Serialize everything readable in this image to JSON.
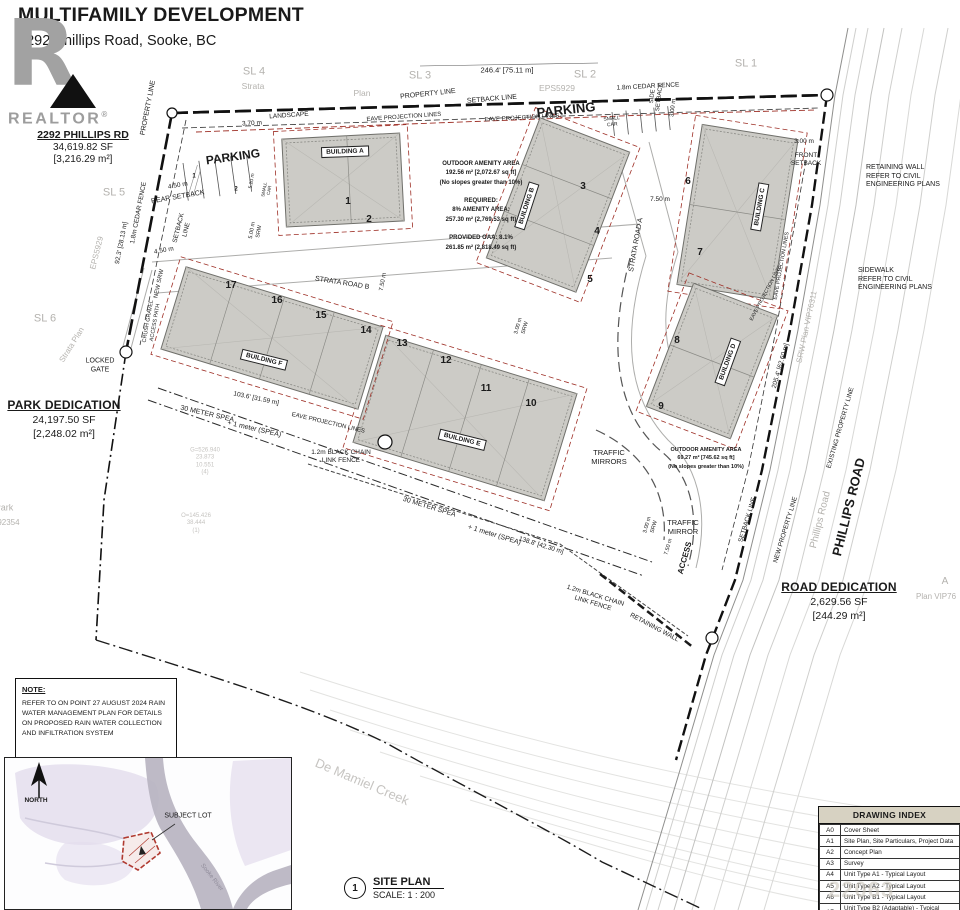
{
  "header": {
    "title": "MULTIFAMILY DEVELOPMENT",
    "subtitle": "2292 Phillips Road, Sooke, BC"
  },
  "logo": {
    "letter": "R",
    "name": "REALTOR",
    "reg": "®"
  },
  "parcel": {
    "name": "2292 PHILLIPS RD",
    "area_sf": "34,619.82 SF",
    "area_m2": "[3,216.29 m²]"
  },
  "park_dedication": {
    "title": "PARK DEDICATION",
    "area_sf": "24,197.50 SF",
    "area_m2": "[2,248.02 m²]"
  },
  "road_dedication": {
    "title": "ROAD DEDICATION",
    "area_sf": "2,629.56 SF",
    "area_m2": "[244.29 m²]"
  },
  "amenity_main": {
    "text": "OUTDOOR AMENITY AREA\n192.56 m² [2,072.67 sq ft]\n(No slopes greater than 10%)\n\nREQUIRED:\n8% AMENITY AREA:\n257.30 m² (2,769.53 sq ft)\n\nPROVIDED OAA: 8.1%\n261.85 m² (2,818.49 sq ft)"
  },
  "amenity_secondary": {
    "text": "OUTDOOR AMENITY AREA\n69.27 m² [745.62 sq ft]\n(No slopes greater than 10%)"
  },
  "note": {
    "heading": "NOTE:",
    "body": "REFER TO ON POINT 27 AUGUST 2024 RAIN\nWATER MANAGEMENT PLAN FOR DETAILS\nON PROPOSED RAIN WATER COLLECTION\nAND INFILTRATION SYSTEM"
  },
  "site_plan_title": {
    "number": "1",
    "label": "SITE PLAN",
    "scale": "SCALE: 1 : 200"
  },
  "drawing_index": {
    "title": "DRAWING INDEX",
    "rows": [
      [
        "A0",
        "Cover Sheet"
      ],
      [
        "A1",
        "Site Plan, Site Particulars, Project Data"
      ],
      [
        "A2",
        "Concept Plan"
      ],
      [
        "A3",
        "Survey"
      ],
      [
        "A4",
        "Unit Type A1 - Typical Layout"
      ],
      [
        "A5",
        "Unit Type A2 - Typical Layout"
      ],
      [
        "A6",
        "Unit Type B1 - Typical Layout"
      ],
      [
        "A7",
        "Unit Type B2 (Adaptable) - Typical Layout"
      ]
    ]
  },
  "watermark": "22063",
  "colors": {
    "grey_label": "#b4b2ae",
    "faint_label": "#c6c4c1",
    "red_dash": "#9e2f26",
    "building_fill": "#cccbc6",
    "index_header_bg": "#d7d2c2",
    "inset_lavender": "#ded8e8",
    "inset_river": "#b7b2c0",
    "subject_lot_red": "#b03a30"
  },
  "annotations": [
    {
      "t": "SL 4",
      "x": 254,
      "y": 72,
      "s": 11,
      "c": "#b4b2ae",
      "n": "sl4-label"
    },
    {
      "t": "Strata",
      "x": 253,
      "y": 86,
      "s": 8.5,
      "c": "#b4b2ae"
    },
    {
      "t": "SL 3",
      "x": 420,
      "y": 76,
      "s": 11,
      "c": "#b4b2ae",
      "n": "sl3-label"
    },
    {
      "t": "Plan",
      "x": 362,
      "y": 93,
      "s": 8.5,
      "c": "#b4b2ae"
    },
    {
      "t": "246.4' [75.11 m]",
      "x": 507,
      "y": 70,
      "s": 7.5,
      "n": "top-dimension"
    },
    {
      "t": "SL 2",
      "x": 585,
      "y": 75,
      "s": 11,
      "c": "#b4b2ae",
      "n": "sl2-label"
    },
    {
      "t": "EPS5929",
      "x": 557,
      "y": 88,
      "s": 8.5,
      "c": "#b4b2ae"
    },
    {
      "t": "SL 1",
      "x": 746,
      "y": 64,
      "s": 11,
      "c": "#b4b2ae",
      "n": "sl1-label"
    },
    {
      "t": "1.8m CEDAR FENCE",
      "x": 648,
      "y": 87,
      "s": 6.5,
      "r": -3,
      "n": "cedar-fence-label"
    },
    {
      "t": "PROPERTY LINE",
      "x": 428,
      "y": 95,
      "s": 7,
      "r": -6
    },
    {
      "t": "SETBACK LINE",
      "x": 492,
      "y": 100,
      "s": 7,
      "r": -5
    },
    {
      "t": "PARKING",
      "x": 566,
      "y": 110,
      "s": 13,
      "b": 1,
      "r": -6,
      "n": "parking-label-east"
    },
    {
      "t": "EAVE PROJECTION LINES",
      "x": 404,
      "y": 118,
      "s": 6,
      "r": -4
    },
    {
      "t": "EAVE PROJECTION LINES",
      "x": 522,
      "y": 119,
      "s": 6,
      "r": -3
    },
    {
      "t": "SMALL\nCAR",
      "x": 612,
      "y": 122,
      "s": 5,
      "r": -6
    },
    {
      "t": "LANDSCAPE",
      "x": 289,
      "y": 116,
      "s": 6.5,
      "r": -4
    },
    {
      "t": "3.70 m",
      "x": 252,
      "y": 124,
      "s": 6.5,
      "r": -3
    },
    {
      "t": "SIDE\nSETBACK",
      "x": 657,
      "y": 97,
      "s": 6,
      "r": -83
    },
    {
      "t": "3.00 m",
      "x": 674,
      "y": 108,
      "s": 6,
      "r": -83
    },
    {
      "t": "3.00 m",
      "x": 804,
      "y": 142,
      "s": 6.5
    },
    {
      "t": "FRONT\nSETBACK",
      "x": 806,
      "y": 160,
      "s": 6.5
    },
    {
      "t": "RETAINING WALL\nREFER TO CIVIL\nENGINEERING PLANS",
      "x": 866,
      "y": 177,
      "s": 7,
      "a": "l",
      "n": "retaining-wall-note"
    },
    {
      "t": "SIDEWALK\nREFER TO CIVIL\nENGINEERING PLANS",
      "x": 858,
      "y": 280,
      "s": 7,
      "a": "l",
      "n": "sidewalk-note"
    },
    {
      "t": "SRW Plan VIP76311",
      "x": 807,
      "y": 327,
      "s": 8,
      "r": -78,
      "c": "#b4b2ae"
    },
    {
      "t": "205.4' [62.60 m]",
      "x": 781,
      "y": 366,
      "s": 6.5,
      "r": -74
    },
    {
      "t": "EXISTING PROPERTY LINE",
      "x": 841,
      "y": 428,
      "s": 6.5,
      "r": -74
    },
    {
      "t": "NEW PROPERTY LINE",
      "x": 786,
      "y": 530,
      "s": 6.5,
      "r": -73
    },
    {
      "t": "SETBACK LINE",
      "x": 748,
      "y": 520,
      "s": 6.5,
      "r": -73
    },
    {
      "t": "Phillips Road",
      "x": 821,
      "y": 520,
      "s": 10,
      "r": -76,
      "c": "#b4b2ae",
      "n": "phillips-road-grey-label"
    },
    {
      "t": "PHILLIPS ROAD",
      "x": 849,
      "y": 507,
      "s": 13,
      "r": -76,
      "b": 1,
      "n": "phillips-road-label"
    },
    {
      "t": "A",
      "x": 945,
      "y": 582,
      "s": 10,
      "c": "#b4b2ae"
    },
    {
      "t": "Plan VIP76",
      "x": 916,
      "y": 597,
      "s": 8,
      "c": "#b4b2ae",
      "a": "l"
    },
    {
      "t": "SL 5",
      "x": 114,
      "y": 193,
      "s": 11,
      "c": "#b4b2ae",
      "n": "sl5-label"
    },
    {
      "t": "EPS5929",
      "x": 97,
      "y": 253,
      "s": 8,
      "r": -76,
      "c": "#b4b2ae"
    },
    {
      "t": "SL 6",
      "x": 45,
      "y": 319,
      "s": 11,
      "c": "#b4b2ae",
      "n": "sl6-label"
    },
    {
      "t": "Strata  Plan",
      "x": 72,
      "y": 345,
      "s": 8,
      "r": -58,
      "c": "#b4b2ae"
    },
    {
      "t": "PROPERTY LINE",
      "x": 149,
      "y": 108,
      "s": 7,
      "r": -79
    },
    {
      "t": "92.3' [28.13 m]",
      "x": 122,
      "y": 243,
      "s": 6.5,
      "r": -79
    },
    {
      "t": "1.8m CEDAR FENCE",
      "x": 139,
      "y": 213,
      "s": 6.5,
      "r": -79
    },
    {
      "t": "REAR SETBACK",
      "x": 178,
      "y": 198,
      "s": 7,
      "r": -10
    },
    {
      "t": "SETBACK\nLINE",
      "x": 183,
      "y": 229,
      "s": 6.5,
      "r": -76
    },
    {
      "t": "4.50 m",
      "x": 178,
      "y": 186,
      "s": 6.5,
      "r": -10
    },
    {
      "t": "4.50 m",
      "x": 164,
      "y": 251,
      "s": 6.5,
      "r": -10
    },
    {
      "t": "NEW SRW",
      "x": 160,
      "y": 284,
      "s": 6,
      "r": -78
    },
    {
      "t": "CRUSH GRAVEL\nACCESS PATH",
      "x": 152,
      "y": 322,
      "s": 5.5,
      "r": -80
    },
    {
      "t": "LOCKED\nGATE",
      "x": 100,
      "y": 366,
      "s": 7,
      "n": "locked-gate-label"
    },
    {
      "t": "30 METER SPEA",
      "x": 207,
      "y": 415,
      "s": 7,
      "r": 13
    },
    {
      "t": "+ 1 meter (SPEA)",
      "x": 254,
      "y": 430,
      "s": 7,
      "r": 13
    },
    {
      "t": "103.6' [31.59 m]",
      "x": 256,
      "y": 399,
      "s": 6.5,
      "r": 12
    },
    {
      "t": "EAVE PROJECTION LINES",
      "x": 328,
      "y": 424,
      "s": 6,
      "r": 13
    },
    {
      "t": "STRATA ROAD B",
      "x": 342,
      "y": 284,
      "s": 7,
      "r": 9,
      "n": "strata-road-b-label"
    },
    {
      "t": "7.50 m",
      "x": 384,
      "y": 282,
      "s": 6,
      "r": -80
    },
    {
      "t": "STRATA ROAD A",
      "x": 637,
      "y": 245,
      "s": 7,
      "r": -80,
      "n": "strata-road-a-label"
    },
    {
      "t": "7.50 m",
      "x": 660,
      "y": 200,
      "s": 6.5
    },
    {
      "t": "TRAFFIC\nMIRRORS",
      "x": 609,
      "y": 457,
      "s": 7.5,
      "n": "traffic-mirrors-label"
    },
    {
      "t": "TRAFFIC\nMIRROR",
      "x": 683,
      "y": 527,
      "s": 7.5
    },
    {
      "t": "ACCESS",
      "x": 685,
      "y": 558,
      "s": 8,
      "b": 1,
      "r": -74,
      "n": "access-label"
    },
    {
      "t": "3.00 m\nSRW",
      "x": 651,
      "y": 526,
      "s": 5.5,
      "r": -74
    },
    {
      "t": "7.50 m",
      "x": 669,
      "y": 547,
      "s": 5.5,
      "r": -74
    },
    {
      "t": "3.00 m\nSRW",
      "x": 522,
      "y": 327,
      "s": 5.5,
      "r": -74
    },
    {
      "t": "5.00 m\nSRW",
      "x": 256,
      "y": 231,
      "s": 5.5,
      "r": -80
    },
    {
      "t": "30 METER SPEA",
      "x": 429,
      "y": 508,
      "s": 7,
      "r": 17
    },
    {
      "t": "+ 1 meter (SPEA)",
      "x": 494,
      "y": 536,
      "s": 7,
      "r": 17
    },
    {
      "t": "138.8' [42.30 m]",
      "x": 541,
      "y": 546,
      "s": 6.5,
      "r": 17
    },
    {
      "t": "1.2m BLACK CHAIN\nLINK FENCE",
      "x": 341,
      "y": 457,
      "s": 6.5
    },
    {
      "t": "1.2m BLACK CHAIN\nLINK FENCE",
      "x": 594,
      "y": 600,
      "s": 6.5,
      "r": 17
    },
    {
      "t": "RETAINING WALL",
      "x": 654,
      "y": 628,
      "s": 6.5,
      "r": 28
    },
    {
      "t": "EAVE PROJECTION LINES",
      "x": 782,
      "y": 266,
      "s": 5.5,
      "r": -80
    },
    {
      "t": "EAVE PROJECTION LINES",
      "x": 766,
      "y": 293,
      "s": 5,
      "r": -62
    },
    {
      "t": "De Mamiel Creek",
      "x": 362,
      "y": 782,
      "s": 13,
      "r": 23,
      "c": "#c6c4c1",
      "n": "creek-label"
    },
    {
      "t": "Park",
      "x": 4,
      "y": 508,
      "s": 9,
      "c": "#b4b2ae"
    },
    {
      "t": "VIP92354",
      "x": 2,
      "y": 523,
      "s": 8,
      "c": "#b4b2ae"
    },
    {
      "t": "G=526.940\n23.873\n10.551\n(4)",
      "x": 205,
      "y": 462,
      "s": 6,
      "c": "#c6c4c1"
    },
    {
      "t": "O=145.426\n38.444\n(1)",
      "x": 196,
      "y": 524,
      "s": 6,
      "c": "#c6c4c1"
    },
    {
      "t": "PARKING",
      "x": 233,
      "y": 157,
      "s": 12,
      "b": 1,
      "r": -8,
      "n": "parking-label-west"
    },
    {
      "t": "1",
      "x": 194,
      "y": 177,
      "s": 6,
      "b": 1
    },
    {
      "t": "2",
      "x": 236,
      "y": 190,
      "s": 6,
      "b": 1
    },
    {
      "t": "5.20 m",
      "x": 252,
      "y": 181,
      "s": 5,
      "r": -80
    },
    {
      "t": "SMALL\nCAR",
      "x": 267,
      "y": 190,
      "s": 4.5,
      "r": -80
    },
    {
      "t": "BUILDING A",
      "x": 345,
      "y": 152,
      "s": 6.5,
      "b": 1,
      "box": 1,
      "r": -2,
      "n": "building-a-label"
    },
    {
      "t": "BUILDING B",
      "x": 527,
      "y": 206,
      "s": 6.5,
      "b": 1,
      "box": 1,
      "r": -72,
      "n": "building-b-label"
    },
    {
      "t": "BUILDING C",
      "x": 760,
      "y": 207,
      "s": 6.5,
      "b": 1,
      "box": 1,
      "r": -80,
      "n": "building-c-label"
    },
    {
      "t": "BUILDING D",
      "x": 728,
      "y": 362,
      "s": 6.5,
      "b": 1,
      "box": 1,
      "r": -70,
      "n": "building-d-label"
    },
    {
      "t": "BUILDING E",
      "x": 462,
      "y": 440,
      "s": 6.5,
      "b": 1,
      "box": 1,
      "r": 14,
      "n": "building-e-label"
    },
    {
      "t": "BUILDING F",
      "x": 264,
      "y": 360,
      "s": 6.5,
      "b": 1,
      "box": 1,
      "r": 14,
      "n": "building-f-label"
    },
    {
      "t": "1",
      "x": 348,
      "y": 202,
      "s": 10,
      "b": 1,
      "n": "unit-1"
    },
    {
      "t": "2",
      "x": 369,
      "y": 220,
      "s": 10,
      "b": 1,
      "n": "unit-2"
    },
    {
      "t": "3",
      "x": 583,
      "y": 187,
      "s": 10,
      "b": 1,
      "n": "unit-3"
    },
    {
      "t": "4",
      "x": 597,
      "y": 232,
      "s": 10,
      "b": 1,
      "n": "unit-4"
    },
    {
      "t": "5",
      "x": 590,
      "y": 280,
      "s": 10,
      "b": 1,
      "n": "unit-5"
    },
    {
      "t": "6",
      "x": 688,
      "y": 182,
      "s": 10,
      "b": 1,
      "n": "unit-6"
    },
    {
      "t": "7",
      "x": 700,
      "y": 253,
      "s": 10,
      "b": 1,
      "n": "unit-7"
    },
    {
      "t": "8",
      "x": 677,
      "y": 341,
      "s": 10,
      "b": 1,
      "n": "unit-8"
    },
    {
      "t": "9",
      "x": 661,
      "y": 407,
      "s": 10,
      "b": 1,
      "n": "unit-9"
    },
    {
      "t": "10",
      "x": 531,
      "y": 404,
      "s": 10,
      "b": 1,
      "n": "unit-10"
    },
    {
      "t": "11",
      "x": 486,
      "y": 389,
      "s": 10,
      "b": 1,
      "n": "unit-11"
    },
    {
      "t": "12",
      "x": 446,
      "y": 361,
      "s": 10,
      "b": 1,
      "n": "unit-12"
    },
    {
      "t": "13",
      "x": 402,
      "y": 344,
      "s": 10,
      "b": 1,
      "n": "unit-13"
    },
    {
      "t": "14",
      "x": 366,
      "y": 331,
      "s": 10,
      "b": 1,
      "n": "unit-14"
    },
    {
      "t": "15",
      "x": 321,
      "y": 316,
      "s": 10,
      "b": 1,
      "n": "unit-15"
    },
    {
      "t": "16",
      "x": 277,
      "y": 301,
      "s": 10,
      "b": 1,
      "n": "unit-16"
    },
    {
      "t": "17",
      "x": 231,
      "y": 286,
      "s": 10,
      "b": 1,
      "n": "unit-17"
    },
    {
      "t": "NORTH",
      "x": 36,
      "y": 801,
      "s": 6.5,
      "b": 1,
      "n": "north-label"
    },
    {
      "t": "SUBJECT LOT",
      "x": 188,
      "y": 817,
      "s": 7,
      "n": "subject-lot-label"
    },
    {
      "t": "Sooke River",
      "x": 211,
      "y": 878,
      "s": 6,
      "r": 52,
      "c": "#8f8b99",
      "n": "sooke-river-label"
    }
  ]
}
